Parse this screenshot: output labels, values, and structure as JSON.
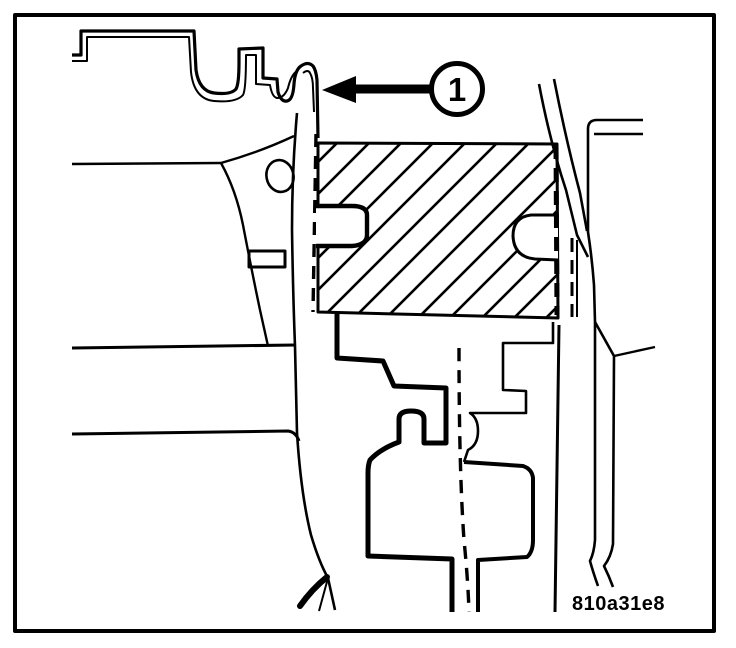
{
  "diagram": {
    "callout": {
      "label": "1"
    },
    "figure_code": "810a31e8",
    "colors": {
      "line": "#000000",
      "background": "#ffffff"
    }
  }
}
